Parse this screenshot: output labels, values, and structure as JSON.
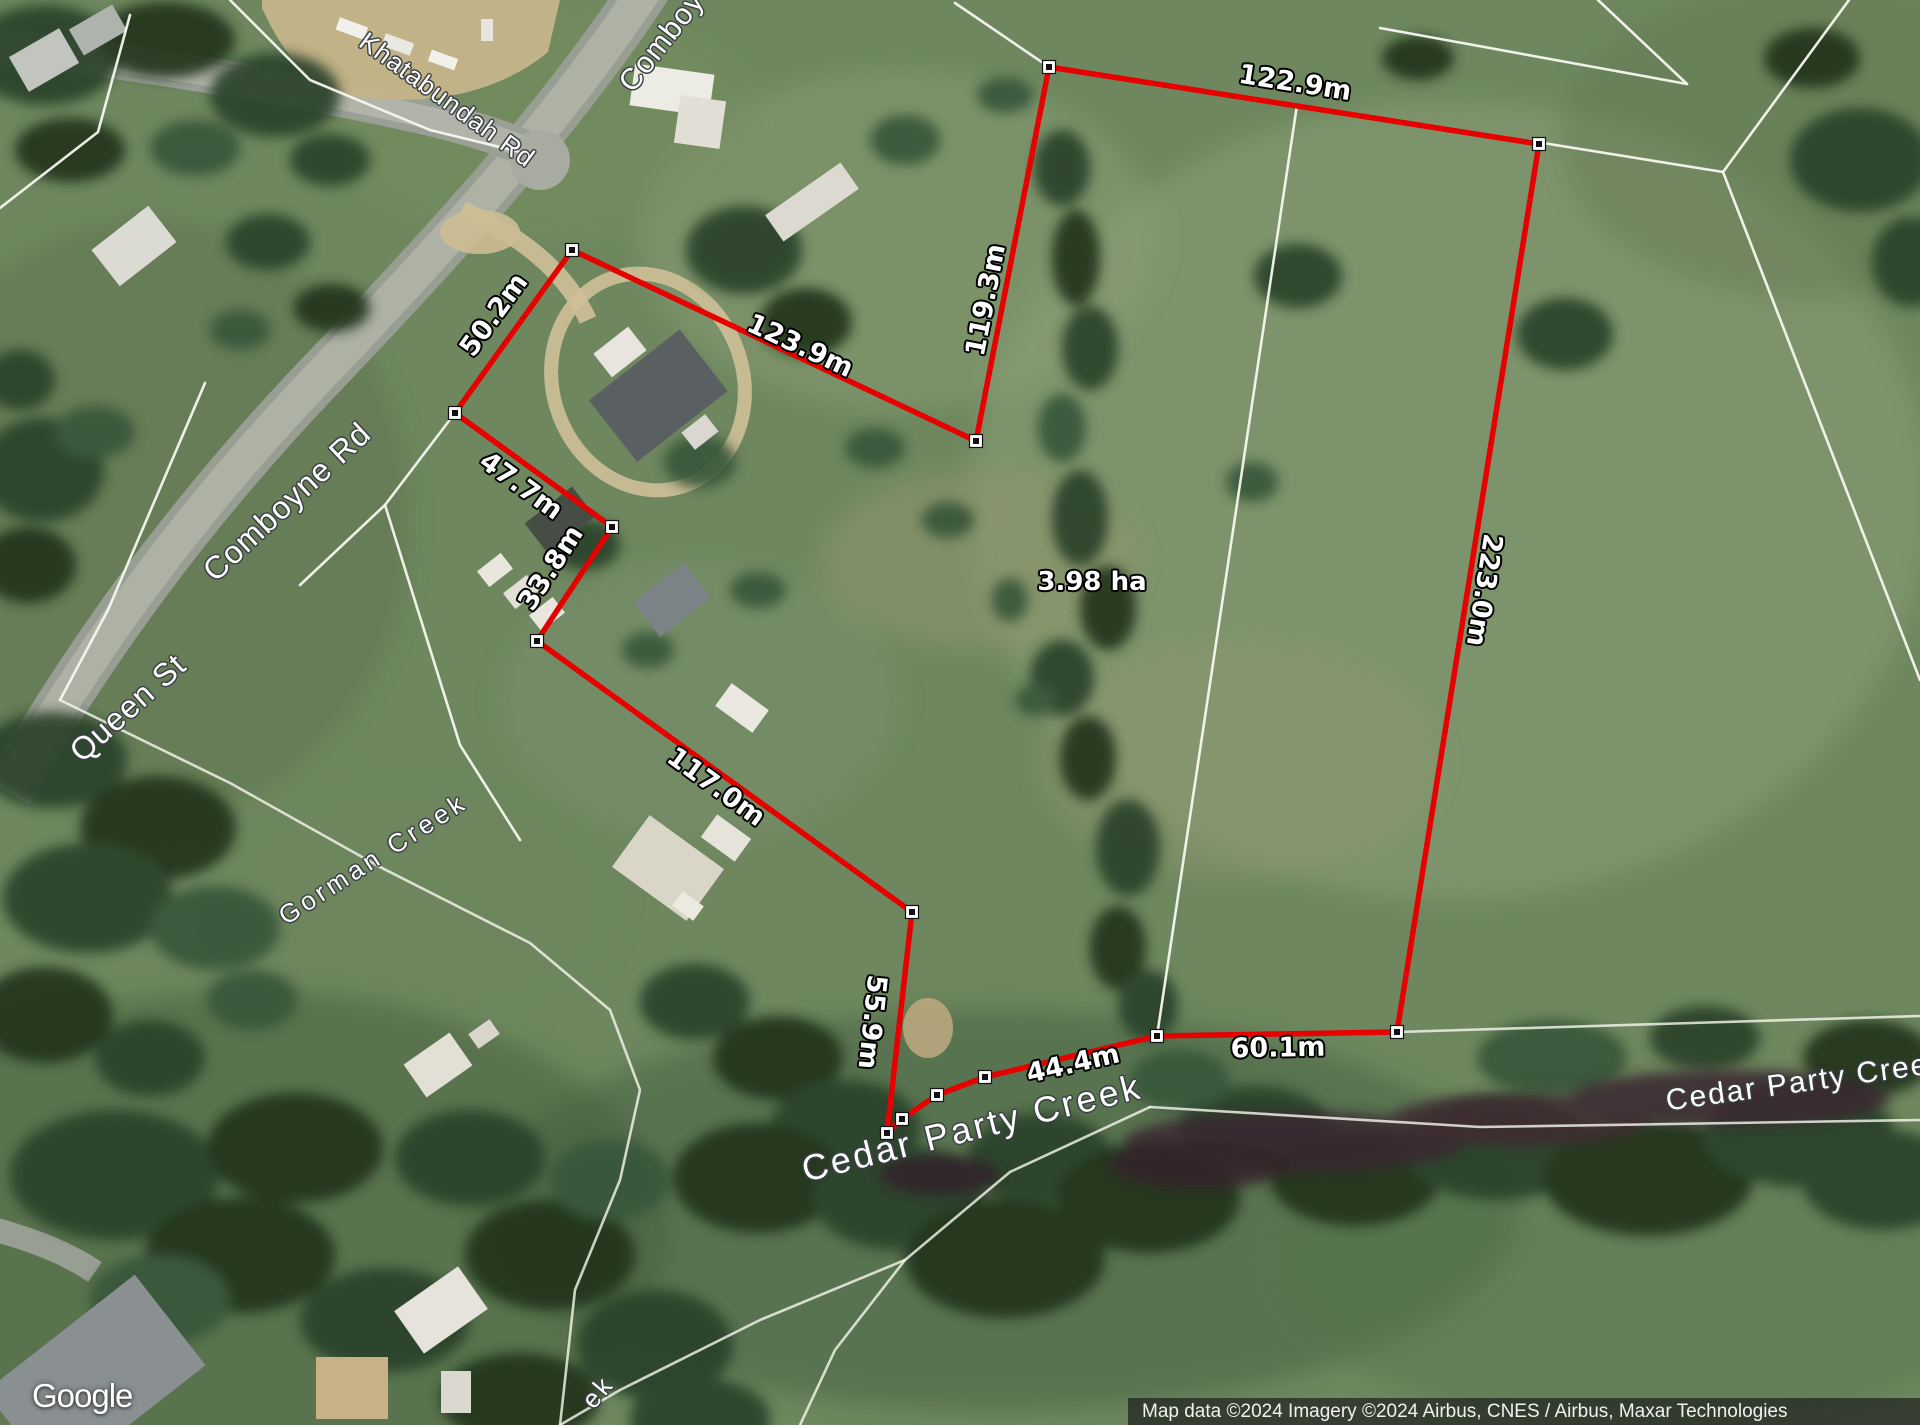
{
  "measurements": {
    "top": "122.9m",
    "inner_left": "119.3m",
    "nw": "123.9m",
    "road_front": "50.2m",
    "west_upper": "47.7m",
    "west_mid": "33.8m",
    "sw_long": "117.0m",
    "south_west": "55.9m",
    "creek_1": "44.4m",
    "creek_2": "60.1m",
    "east": "223.0m"
  },
  "area": {
    "label": "3.98 ha"
  },
  "places": {
    "khatabundah_rd": "Khatabundah Rd",
    "comboyne_rd_top": "Comboy",
    "comboyne_rd": "Comboyne Rd",
    "queen_st": "Queen St",
    "gorman_creek": "Gorman Creek",
    "cedar_party_creek_main": "Cedar Party Creek",
    "cedar_party_creek_east": "Cedar Party Creek",
    "creek_label_partial": "ek"
  },
  "branding": {
    "logo_text": "Google"
  },
  "attribution": {
    "text": "Map data ©2024 Imagery ©2024 Airbus, CNES / Airbus, Maxar Technologies"
  },
  "colors": {
    "parcel_outline": "#e60000",
    "cadastre_line": "#f7f7ef",
    "measurement_text": "#ffffff",
    "place_text": "#ffffff"
  }
}
